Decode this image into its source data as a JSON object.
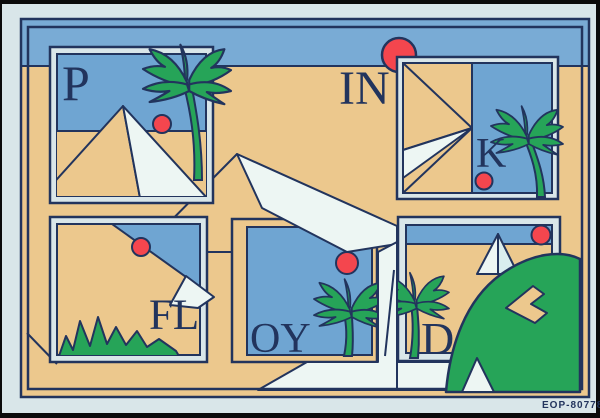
{
  "title_letters": {
    "p": "P",
    "in": "IN",
    "k": "K",
    "fl": "FL",
    "oy": "OY",
    "d": "D"
  },
  "caption": {
    "code": "EOP-80778"
  },
  "colors": {
    "navy": "#22345d",
    "sky": "#79abd5",
    "panel-blue": "#6fa5d2",
    "sand": "#ecc88d",
    "green": "#26a458",
    "red": "#f4464e",
    "white": "#edf6f3",
    "shade": "#d9edee",
    "pale": "#d9e6e9",
    "black": "#0b0b0b"
  }
}
